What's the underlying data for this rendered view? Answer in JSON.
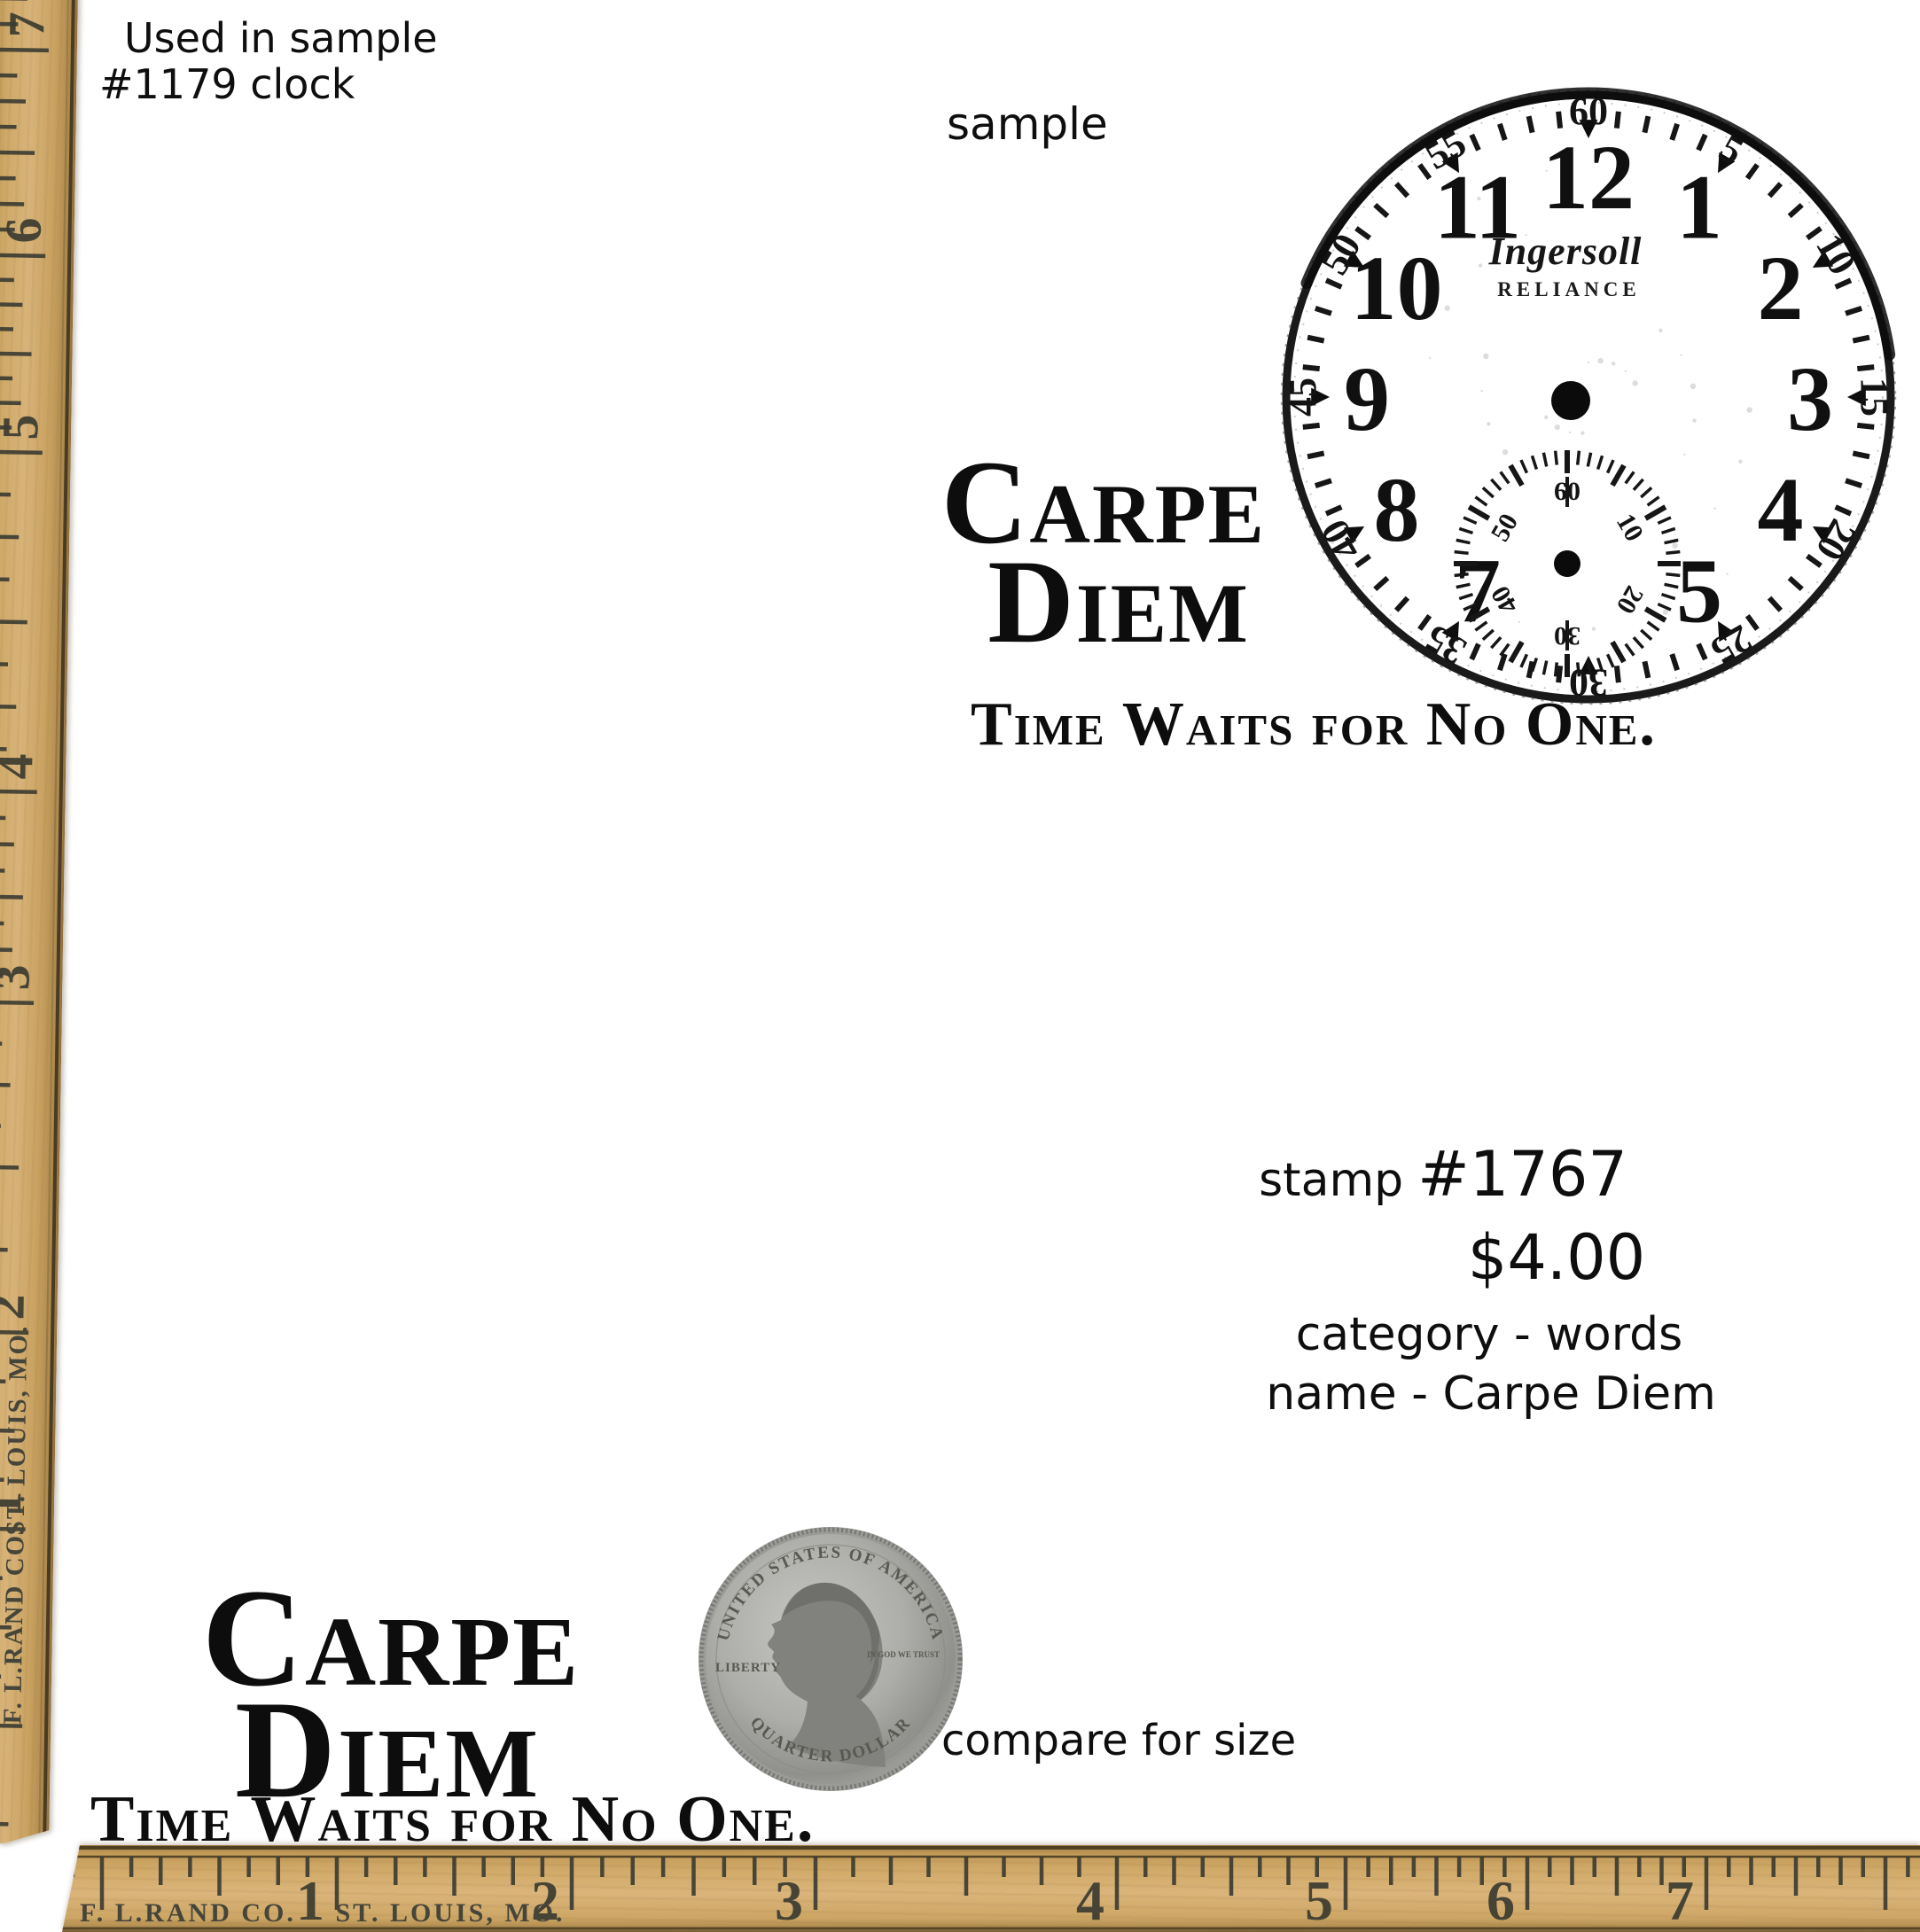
{
  "captions": {
    "used_line1": "Used in sample",
    "used_line2": "#1179 clock",
    "sample": "sample",
    "compare": "compare for size"
  },
  "product": {
    "stamp_label": "stamp",
    "stamp_number": "#1767",
    "price": "$4.00",
    "category_line": "category - words",
    "name_line": "name - Carpe Diem"
  },
  "stamp_design": {
    "line1": "Carpe",
    "line2": "Diem",
    "line3": "Time Waits for No One."
  },
  "watch": {
    "brand": "Ingersoll",
    "model": "RELIANCE",
    "hour_numerals": [
      "12",
      "1",
      "2",
      "3",
      "4",
      "5",
      "7",
      "8",
      "9",
      "10",
      "11"
    ],
    "minute_numerals": [
      "60",
      "5",
      "10",
      "15",
      "20",
      "25",
      "30",
      "35",
      "40",
      "45",
      "50",
      "55"
    ],
    "subdial_numerals": [
      "60",
      "10",
      "20",
      "30",
      "40",
      "50"
    ]
  },
  "rulers": {
    "maker": "F. L.RAND CO.",
    "city": "ST. LOUIS, MO.",
    "left_numbers": [
      "7",
      "6",
      "5",
      "4",
      "3",
      "2",
      "1"
    ],
    "bottom_numbers": [
      "1",
      "2",
      "3",
      "4",
      "5",
      "6",
      "7"
    ],
    "wood_color": "#cfa968",
    "tick_color": "#3d3d33"
  },
  "coin": {
    "top_text": "UNITED STATES OF AMERICA",
    "bottom_text": "QUARTER DOLLAR",
    "left_text": "LIBERTY",
    "right_text": "IN GOD WE TRUST"
  }
}
